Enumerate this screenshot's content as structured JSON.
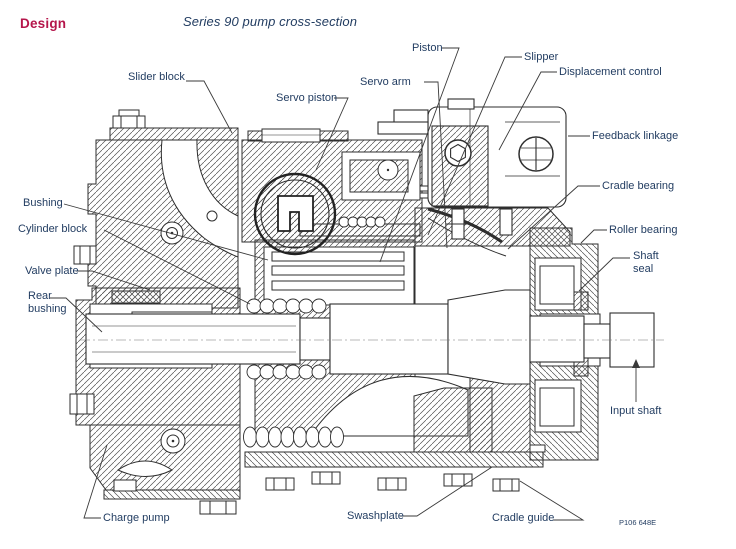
{
  "document": {
    "heading": "Design",
    "title": "Series 90 pump cross-section",
    "figure_code": "P106 648E"
  },
  "colors": {
    "heading": "#B5164B",
    "label_text": "#1F3A5F",
    "drawing_line": "#2E2E2E",
    "background": "#FFFFFF"
  },
  "labels": {
    "slider_block": "Slider block",
    "servo_piston": "Servo piston",
    "servo_arm": "Servo arm",
    "piston": "Piston",
    "slipper": "Slipper",
    "displacement_control": "Displacement control",
    "feedback_linkage": "Feedback linkage",
    "cradle_bearing": "Cradle bearing",
    "roller_bearing": "Roller bearing",
    "shaft_seal": "Shaft seal",
    "input_shaft": "Input shaft",
    "bushing": "Bushing",
    "cylinder_block": "Cylinder block",
    "valve_plate": "Valve plate",
    "rear_bushing": "Rear bushing",
    "charge_pump": "Charge pump",
    "swashplate": "Swashplate",
    "cradle_guide": "Cradle guide"
  }
}
